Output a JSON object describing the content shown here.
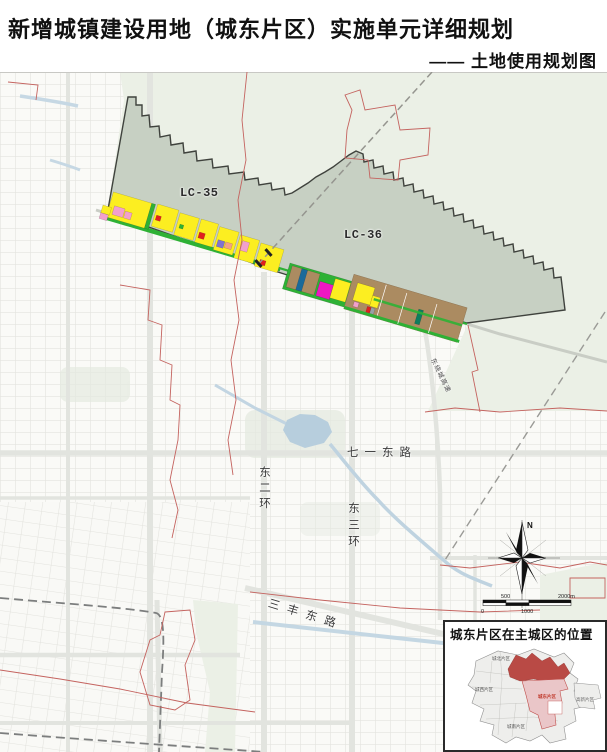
{
  "header": {
    "title": "新增城镇建设用地（城东片区）实施单元详细规划",
    "subtitle": "—— 土地使用规划图"
  },
  "map": {
    "zone_labels": {
      "lc35": "LC-35",
      "lc36": "LC-36"
    },
    "roads": {
      "qiyi_east_rd": "七一东路",
      "east_2nd_ring": "东二环",
      "east_3rd_ring": "东三环",
      "sanfeng_east_rd": "三丰东路",
      "east_bypass": "东绕城高速"
    },
    "compass": {
      "north": "N"
    },
    "scalebar": {
      "n0": "0",
      "n500": "500",
      "n1000": "1000",
      "n2000": "2000m"
    }
  },
  "inset": {
    "title": "城东片区在主城区的位置",
    "districts": {
      "north": "城北片区",
      "west": "城西片区",
      "south": "城南片区",
      "east": "城东片区",
      "hightech": "高新片区"
    }
  },
  "colors": {
    "planning_area_fill": "#c7d0c3",
    "open_land_green": "#ebf0e6",
    "residential_yellow": "#fcee21",
    "village_brown": "#ab8b61",
    "commercial_red": "#e0201f",
    "greenway_green": "#2eb135",
    "pink": "#f2a0cc",
    "magenta": "#ee17c3",
    "purple": "#8173cf",
    "orange_salmon": "#f4a384",
    "teal": "#0e7d5e",
    "blue": "#1a6a9a",
    "water_blue": "#b7cedd",
    "boundary_red": "#c4635f",
    "inset_highlight_dark": "#b94a45",
    "inset_highlight_pink": "#eac6c8"
  }
}
